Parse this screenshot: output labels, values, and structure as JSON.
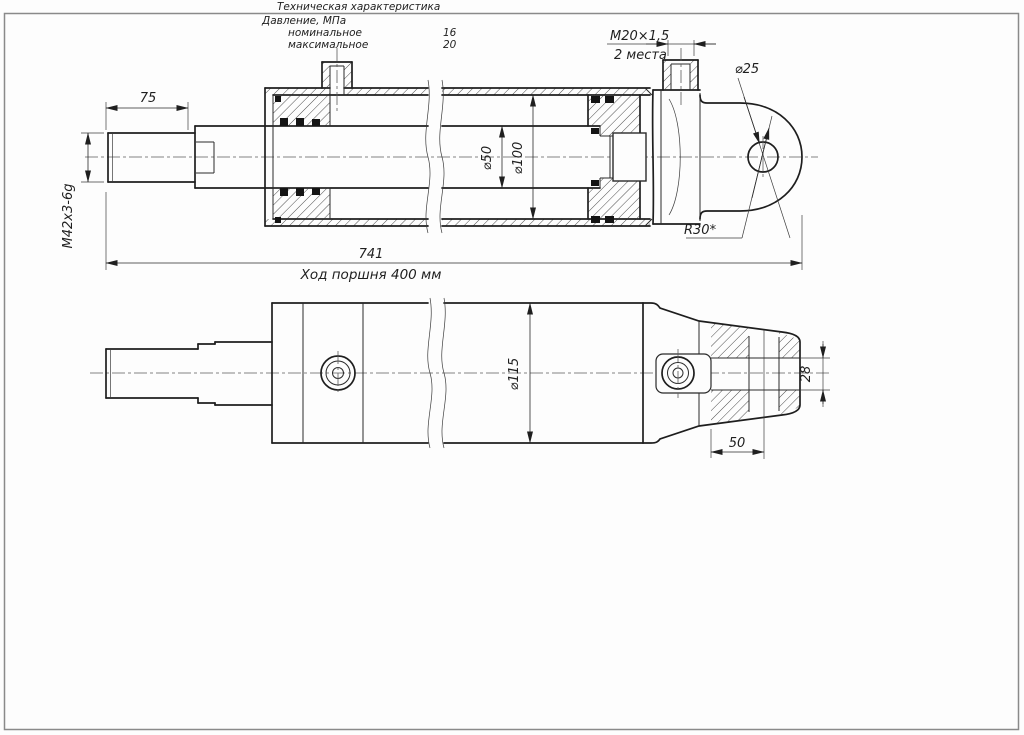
{
  "sheet": {
    "background": "#fdfdfd",
    "line_color": "#1e1e1e",
    "spec_table": {
      "title": "Техническая характеристика",
      "group_label": "Давление, МПа",
      "rows": [
        {
          "label": "номинальное",
          "value": "16"
        },
        {
          "label": "максимальное",
          "value": "20"
        }
      ]
    },
    "views": {
      "section_view": {
        "name": "hydraulic cylinder — longitudinal section",
        "dims": {
          "rod_thread_len": "75",
          "rod_thread": "М42х3-6g",
          "port_thread": "М20×1,5",
          "port_note": "2 места",
          "eye_dia": "⌀25",
          "rod_dia": "⌀50",
          "bore_dia": "⌀100",
          "nose_radius": "R30*",
          "total_len": "741",
          "stroke_note": "Ход поршня 400 мм"
        }
      },
      "outside_view": {
        "name": "hydraulic cylinder — outside view",
        "dims": {
          "body_dia": "⌀115",
          "slot_width": "28",
          "eye_offset": "50"
        }
      }
    }
  }
}
